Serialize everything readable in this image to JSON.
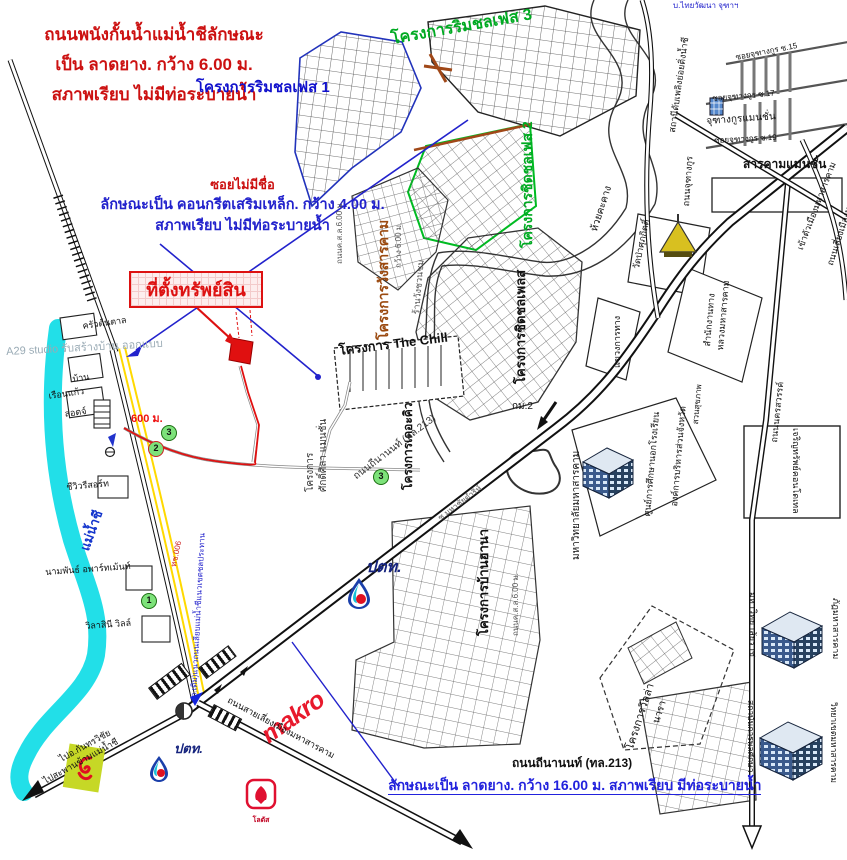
{
  "colors": {
    "annotation_red": "#cc1111",
    "annotation_blue": "#2222cc",
    "project_green": "#00aa22",
    "project_brown": "#9b4a10",
    "river_cyan": "#22dfe8",
    "soi_yellow": "#ffd900",
    "property_red": "#e01010",
    "makro_red": "#e8192c",
    "ptt_navy": "#16247e"
  },
  "annotations": {
    "levee": {
      "line1": "ถนนพนังกั้นน้ำแม่น้ำชีลักษณะ",
      "line2": "เป็น ลาดยาง. กว้าง 6.00 ม.",
      "line3": "สภาพเรียบ ไม่มีท่อระบายน้ำ"
    },
    "soi": {
      "title": "ซอยไม่มีชื่อ",
      "line1": "ลักษณะเป็น คอนกรีตเสริมเหล็ก. กว้าง 4.00 ม.",
      "line2": "สภาพเรียบ ไม่มีท่อระบายน้ำ"
    },
    "property_label": "ที่ตั้งทรัพย์สิน",
    "distance_label": "600 ม.",
    "highway_name": "ถนนถีนานนท์ (ทล.213)",
    "highway_desc": "ลักษณะเป็น ลาดยาง. กว้าง 16.00 ม. สภาพเรียบ มีท่อระบายน้ำ",
    "watermark": "A29 studio รับสร้างบ้าน ออกแบบ"
  },
  "logos": {
    "ptt": "ปตท.",
    "makro": "makro",
    "lotus": "โลตัส"
  },
  "markers": [
    {
      "n": "1",
      "x": 141,
      "y": 593,
      "ring": "#1c6d12"
    },
    {
      "n": "2",
      "x": 148,
      "y": 441,
      "ring": "#cc2222"
    },
    {
      "n": "3",
      "x": 161,
      "y": 425,
      "ring": "#1c6d12"
    },
    {
      "n": "3",
      "x": 373,
      "y": 469,
      "ring": "#1c6d12"
    }
  ],
  "map_labels": [
    {
      "n": "project-rimchon-phase1",
      "t": "โครงการริมชลเฟส 1",
      "x": 196,
      "y": 80,
      "r": 0,
      "c": "#1111cc",
      "s": 15,
      "b": 1
    },
    {
      "n": "project-rimchon-phase3",
      "t": "โครงการริมชลเฟส 3",
      "x": 390,
      "y": 32,
      "r": -10,
      "c": "#00aa22",
      "s": 16,
      "b": 1
    },
    {
      "n": "project-chidchon-phase2",
      "t": "โครงการชิดชลเฟส 2",
      "x": 520,
      "y": 248,
      "r": -90,
      "c": "#00aa22",
      "s": 14,
      "b": 1
    },
    {
      "n": "project-wangsarakham",
      "t": "โครงการวังสารคาม",
      "x": 376,
      "y": 340,
      "r": -90,
      "c": "#9b4a10",
      "s": 14,
      "b": 1
    },
    {
      "n": "road-width-6m",
      "t": "กว้าง 6.00 ม.",
      "x": 395,
      "y": 268,
      "r": -90,
      "c": "#555555",
      "s": 8
    },
    {
      "n": "road-csl-6m-north",
      "t": "ถนนค.ส.ล.6.00 ม.",
      "x": 336,
      "y": 264,
      "r": -90,
      "c": "#555555",
      "s": 8
    },
    {
      "n": "shop-wangchuanchom",
      "t": "ร้านวังชวนชม",
      "x": 412,
      "y": 314,
      "r": -85,
      "c": "#555555",
      "s": 9
    },
    {
      "n": "project-the-chill",
      "t": "โครงการ The Chill",
      "x": 338,
      "y": 344,
      "r": -7,
      "c": "#111111",
      "s": 13,
      "b": 1
    },
    {
      "n": "project-chidchon-place",
      "t": "โครงการชิดชลเพลส",
      "x": 514,
      "y": 384,
      "r": -90,
      "c": "#111111",
      "s": 13,
      "b": 1
    },
    {
      "n": "project-the-kew",
      "t": "โครงการเดอะคิว",
      "x": 402,
      "y": 490,
      "r": -90,
      "c": "#111111",
      "s": 12,
      "b": 1
    },
    {
      "n": "project-label",
      "t": "โครงการ",
      "x": 306,
      "y": 492,
      "r": -90,
      "c": "#333333",
      "s": 10
    },
    {
      "n": "saksila-mansion",
      "t": "ศักดิ์ศิลา แมนชั่น",
      "x": 319,
      "y": 492,
      "r": -90,
      "c": "#333333",
      "s": 10
    },
    {
      "n": "project-baan-hana",
      "t": "โครงการบ้านฮานา",
      "x": 477,
      "y": 636,
      "r": -90,
      "c": "#111111",
      "s": 13,
      "b": 1
    },
    {
      "n": "road-csl-6m-south",
      "t": "ถนนค.ส.ล.6.00 ม.",
      "x": 512,
      "y": 636,
      "r": -90,
      "c": "#555555",
      "s": 8
    },
    {
      "n": "road-thinanon-inline",
      "t": "ถนนถีนานนท์ (ทล.213)",
      "x": 352,
      "y": 474,
      "r": -37,
      "c": "#333333",
      "s": 10
    },
    {
      "n": "soi-mahachai",
      "t": "ซ.มหาชัยดำริห์",
      "x": 437,
      "y": 516,
      "r": -37,
      "c": "#555555",
      "s": 8
    },
    {
      "n": "msu-university",
      "t": "มหาวิทยาลัยมหาสารคาม",
      "x": 572,
      "y": 560,
      "r": -90,
      "c": "#111111",
      "s": 10
    },
    {
      "n": "project-villa",
      "t": "โครงการวิลล่า",
      "x": 625,
      "y": 748,
      "r": -72,
      "c": "#111111",
      "s": 11
    },
    {
      "n": "project-villa-nara",
      "t": "นารา",
      "x": 652,
      "y": 722,
      "r": -72,
      "c": "#111111",
      "s": 10
    },
    {
      "n": "stream-huai-khakhang",
      "t": "ห้วยคะคาง",
      "x": 590,
      "y": 230,
      "r": -72,
      "c": "#111111",
      "s": 10
    },
    {
      "n": "wat-pa-supakit",
      "t": "วัดป่าศุภกิตติ์",
      "x": 632,
      "y": 268,
      "r": -78,
      "c": "#111111",
      "s": 9
    },
    {
      "n": "highway-office-1",
      "t": "สำนักงานทาง",
      "x": 703,
      "y": 346,
      "r": -85,
      "c": "#111111",
      "s": 9
    },
    {
      "n": "highway-office-2",
      "t": "หลวงมหาสารคาม",
      "x": 716,
      "y": 350,
      "r": -85,
      "c": "#111111",
      "s": 9
    },
    {
      "n": "khwaeng-kan-thang",
      "t": "แขวงการทาง",
      "x": 613,
      "y": 368,
      "r": -90,
      "c": "#111111",
      "s": 9
    },
    {
      "n": "fire-substation",
      "t": "สถานีดับเพลิงย่อยติ่งน้ำชี",
      "x": 668,
      "y": 132,
      "r": -82,
      "c": "#111111",
      "s": 9
    },
    {
      "n": "road-juthangkun",
      "t": "ถนนจุฑางกูร",
      "x": 682,
      "y": 206,
      "r": -86,
      "c": "#111111",
      "s": 9
    },
    {
      "n": "thaiwat-company",
      "t": "บ.ไทยวัฒนา จุฑาฯ",
      "x": 673,
      "y": 2,
      "r": 0,
      "c": "#2222cc",
      "s": 8
    },
    {
      "n": "soi-juthangkun-15",
      "t": "ซอยจุฑางกูร ซ.15",
      "x": 735,
      "y": 54,
      "r": -11,
      "c": "#111111",
      "s": 8
    },
    {
      "n": "soi-juthangkun-17",
      "t": "ซอยจุฑางกูร ซ.17",
      "x": 712,
      "y": 95,
      "r": -5,
      "c": "#111111",
      "s": 8
    },
    {
      "n": "juthangkun-mansion",
      "t": "จุฑางกูรแมนชั่น",
      "x": 706,
      "y": 117,
      "r": -4,
      "c": "#111111",
      "s": 10
    },
    {
      "n": "soi-juthangkun-19",
      "t": "ซอยจุฑางกูร ซ.19",
      "x": 714,
      "y": 137,
      "r": -3,
      "c": "#111111",
      "s": 8
    },
    {
      "n": "sarakham-mansion",
      "t": "สารคามแมนชั่น",
      "x": 743,
      "y": 158,
      "r": 0,
      "c": "#111111",
      "s": 12,
      "b": 1
    },
    {
      "n": "into-city",
      "t": "เข้าตัวเมืองมหาสารคาม",
      "x": 796,
      "y": 248,
      "r": -69,
      "c": "#111111",
      "s": 9
    },
    {
      "n": "bypass-road-ne",
      "t": "ถนนเลี่ยงเมืองมหาสารคาม",
      "x": 826,
      "y": 264,
      "r": -72,
      "c": "#111111",
      "s": 9
    },
    {
      "n": "road-nakhonsawan",
      "t": "ถนนนครสวรรค์",
      "x": 770,
      "y": 442,
      "r": -84,
      "c": "#111111",
      "s": 9
    },
    {
      "n": "charoensap-condotel",
      "t": "เจริญทรัพย์คอนโดเทล",
      "x": 800,
      "y": 428,
      "r": 90,
      "c": "#111111",
      "s": 9
    },
    {
      "n": "nfe-center",
      "t": "ศูนย์การศึกษานอกโรงเรียน",
      "x": 643,
      "y": 516,
      "r": -85,
      "c": "#111111",
      "s": 9
    },
    {
      "n": "provincial-admin-org",
      "t": "องค์การบริหารส่วนจังหวัด",
      "x": 670,
      "y": 506,
      "r": -85,
      "c": "#111111",
      "s": 9
    },
    {
      "n": "health-park",
      "t": "สวนสุขภาพ",
      "x": 692,
      "y": 424,
      "r": -85,
      "c": "#111111",
      "s": 8
    },
    {
      "n": "rajabhat-university-1",
      "t": "มหาวิทยาลัยราช",
      "x": 757,
      "y": 592,
      "r": 90,
      "c": "#111111",
      "s": 9
    },
    {
      "n": "rajabhat-university-2",
      "t": "ภัฏมหาสารคาม",
      "x": 840,
      "y": 598,
      "r": 90,
      "c": "#111111",
      "s": 9
    },
    {
      "n": "inst-physical-edu-1",
      "t": "สถาบันการพลศึกษา",
      "x": 755,
      "y": 700,
      "r": 90,
      "c": "#111111",
      "s": 8.5
    },
    {
      "n": "inst-physical-edu-2",
      "t": "วิทยาเขตมหาสารคาม",
      "x": 838,
      "y": 702,
      "r": 90,
      "c": "#111111",
      "s": 8.5
    },
    {
      "n": "bypass-road-se",
      "t": "ถนนสายเลี่ยงเมืองมหาสารคาม",
      "x": 230,
      "y": 696,
      "r": 28,
      "c": "#111111",
      "s": 9
    },
    {
      "n": "to-kantharawichai",
      "t": "ไปอ.กันทรวิชัย",
      "x": 58,
      "y": 756,
      "r": -29,
      "c": "#111111",
      "s": 9
    },
    {
      "n": "to-chi-bridge",
      "t": "ไปสะพานข้ามแม่น้ำชี",
      "x": 42,
      "y": 778,
      "r": -29,
      "c": "#111111",
      "s": 9
    },
    {
      "n": "chi-river-name",
      "t": "แม่น้ำชี",
      "x": 78,
      "y": 548,
      "r": -70,
      "c": "#1133cc",
      "s": 13,
      "b": 1
    },
    {
      "n": "krua-tontan",
      "t": "ครัวต้นตาล",
      "x": 82,
      "y": 322,
      "r": -8,
      "c": "#111111",
      "s": 9
    },
    {
      "n": "baan-house",
      "t": "บ้าน",
      "x": 72,
      "y": 375,
      "r": -8,
      "c": "#111111",
      "s": 9
    },
    {
      "n": "rueankaew",
      "t": "เรือนแก้ว",
      "x": 48,
      "y": 392,
      "r": -8,
      "c": "#111111",
      "s": 9
    },
    {
      "n": "rueankaew-lodge",
      "t": "ลอดจ์",
      "x": 64,
      "y": 410,
      "r": -8,
      "c": "#111111",
      "s": 9
    },
    {
      "n": "cheeview-resort",
      "t": "ชีวิวรีสอร์ท",
      "x": 66,
      "y": 483,
      "r": -5,
      "c": "#111111",
      "s": 9
    },
    {
      "n": "nampan-apartment",
      "t": "นามพันธ์ อพาร์ทเม้นท์",
      "x": 45,
      "y": 568,
      "r": -4,
      "c": "#111111",
      "s": 9
    },
    {
      "n": "wilasinee-ville",
      "t": "วิลาสินี วิลล์",
      "x": 85,
      "y": 622,
      "r": -4,
      "c": "#111111",
      "s": 9
    },
    {
      "n": "old-levee-road",
      "t": "(ถ.เดิม)แนวถนนเลียบแม่น้ำชีแนวเขตชลประทาน",
      "x": 190,
      "y": 700,
      "r": -87,
      "c": "#2222cc",
      "s": 8
    },
    {
      "n": "road-code-tch006",
      "t": "ทช.006",
      "x": 170,
      "y": 566,
      "r": -78,
      "c": "#cc2222",
      "s": 8
    },
    {
      "n": "km2-label",
      "t": "กม.2",
      "x": 512,
      "y": 402,
      "r": 0,
      "c": "#111111",
      "s": 10
    }
  ]
}
